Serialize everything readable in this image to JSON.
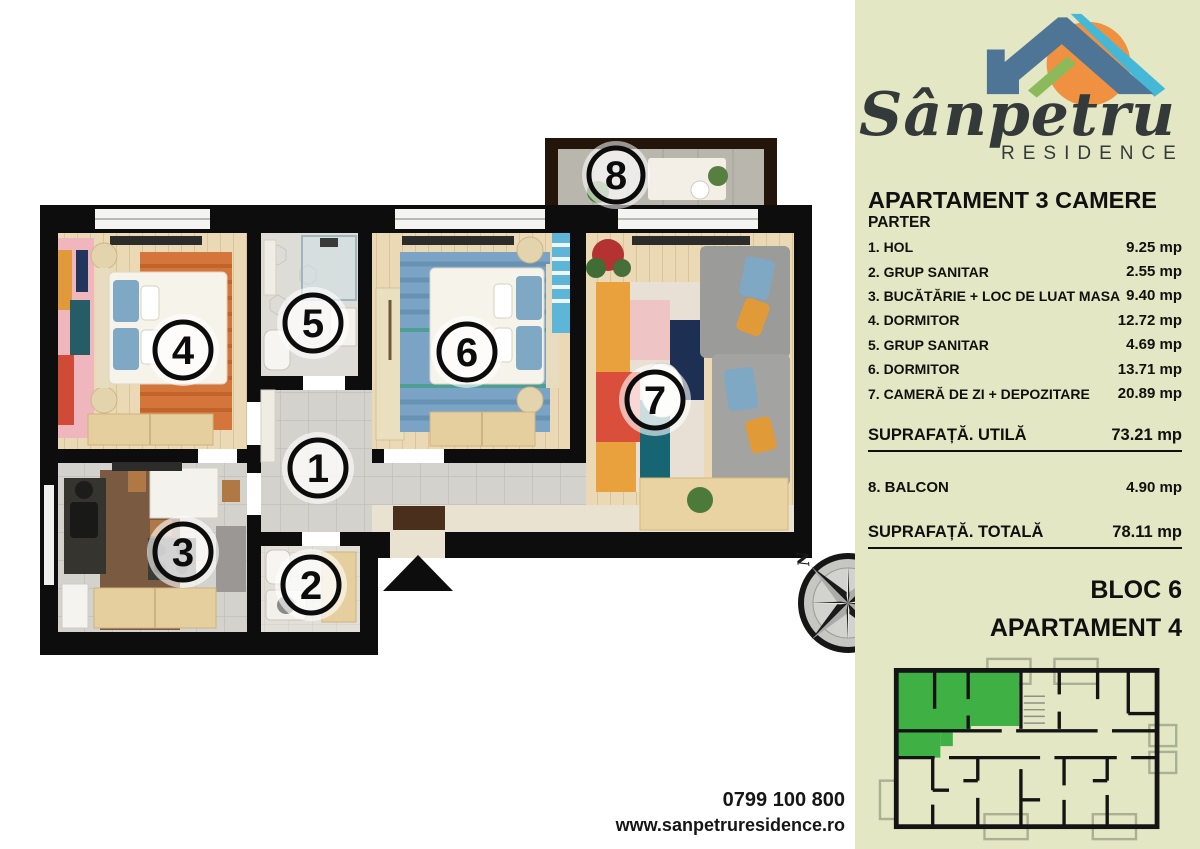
{
  "brand": {
    "name": "Sânpetru",
    "subtitle": "RESIDENCE"
  },
  "listing": {
    "title": "APARTAMENT 3 CAMERE",
    "floor": "PARTER"
  },
  "rooms": [
    {
      "num": "1",
      "label": "1. HOL",
      "area": "9.25 mp"
    },
    {
      "num": "2",
      "label": "2. GRUP SANITAR",
      "area": "2.55 mp"
    },
    {
      "num": "3",
      "label": "3. BUCĂTĂRIE + LOC DE LUAT MASA",
      "area": "9.40 mp"
    },
    {
      "num": "4",
      "label": "4. DORMITOR",
      "area": "12.72 mp"
    },
    {
      "num": "5",
      "label": "5. GRUP SANITAR",
      "area": "4.69 mp"
    },
    {
      "num": "6",
      "label": "6. DORMITOR",
      "area": "13.71 mp"
    },
    {
      "num": "7",
      "label": "7. CAMERĂ DE ZI + DEPOZITARE",
      "area": "20.89 mp"
    }
  ],
  "summary": {
    "usable_label": "SUPRAFAȚĂ. UTILĂ",
    "usable_value": "73.21 mp",
    "balcony_label": "8. BALCON",
    "balcony_value": "4.90 mp",
    "total_label": "SUPRAFAȚĂ. TOTALĂ",
    "total_value": "78.11 mp"
  },
  "unit": {
    "block": "BLOC 6",
    "apartment": "APARTAMENT 4"
  },
  "contact": {
    "phone": "0799 100 800",
    "website": "www.sanpetruresidence.ro"
  },
  "plan": {
    "markers": [
      "1",
      "2",
      "3",
      "4",
      "5",
      "6",
      "7",
      "8"
    ],
    "compass_north": "N"
  },
  "colors": {
    "sidebar_bg": "#e3e7c3",
    "logo_blue": "#4e7596",
    "logo_cyan": "#45b8d8",
    "logo_green": "#8cba5a",
    "logo_orange": "#ef9140",
    "apartment_highlight": "#3fb044",
    "wall_black": "#0d0d0d"
  }
}
